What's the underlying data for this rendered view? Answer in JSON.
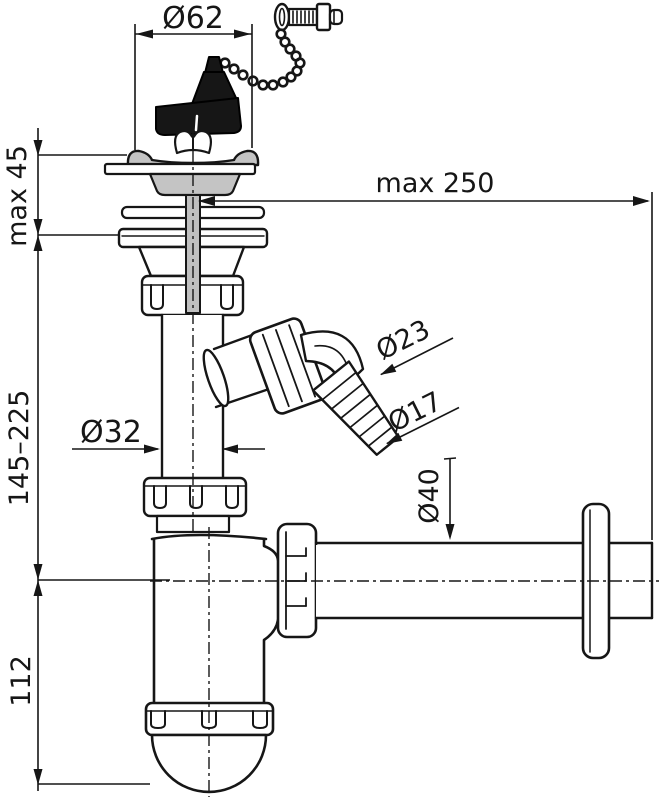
{
  "drawing": {
    "labels": {
      "strainer_diameter": "Ø62",
      "max_wall_distance": "max 250",
      "max_deck_thickness": "max 45",
      "height_range": "145–225",
      "trap_height": "112",
      "tailpipe_diameter": "Ø32",
      "hose_barb_large": "Ø23",
      "hose_barb_small": "Ø17",
      "outlet_diameter": "Ø40"
    },
    "colors": {
      "line": "#161616",
      "gray_fill": "#c4c4c4",
      "dark_fill": "#161616",
      "background": "#ffffff"
    }
  }
}
